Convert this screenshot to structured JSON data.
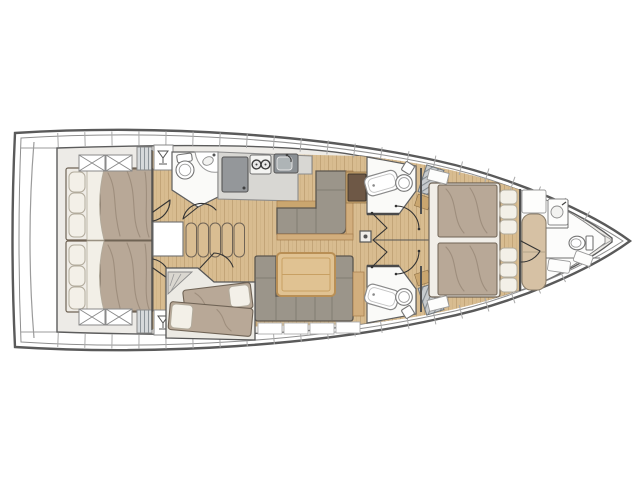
{
  "document": {
    "type": "sailing yacht interior layout floor plan",
    "view": "overhead deck plan",
    "bow_direction": "right",
    "background": "#ffffff"
  },
  "colors": {
    "hull_outline": "#5a5a5a",
    "deck_line": "#8f8f8f",
    "interior_fill": "#edebe7",
    "wood_floor": "#d8bc90",
    "wood_plank_line": "#c3a578",
    "wall": "#4f4f4f",
    "mattress": "#b8a897",
    "mattress_outline": "#6f6355",
    "pillow": "#f3f0e8",
    "pillow_stroke": "#b2ab9c",
    "settee_gray": "#9b958a",
    "settee_outline": "#5b564e",
    "wood_trim": "#d2ae7d",
    "table_wood": "#e0c292",
    "table_frame": "#b98f55",
    "counter_gray": "#d8d7d3",
    "appliance_gray": "#94979a",
    "sink_gray": "#8a8f93",
    "nav_table_brown": "#6e5846",
    "stairs_wood": "#d9bd92",
    "bow_berth_beige": "#d6c1a4",
    "fixture_white": "#fbfbfa",
    "fixture_stroke": "#757575",
    "hatch_stripe": "#8d9499",
    "door_line": "#333333"
  },
  "regions": [
    {
      "id": "swim-platform"
    },
    {
      "id": "aft-cabin-port",
      "fixtures": [
        "double-berth",
        "pillows",
        "hatch-cross-locker",
        "louvered-locker",
        "hanging-locker"
      ]
    },
    {
      "id": "aft-cabin-starboard",
      "fixtures": [
        "double-berth",
        "pillows",
        "hatch-cross-locker",
        "louvered-locker",
        "hanging-locker"
      ]
    },
    {
      "id": "companionway",
      "fixtures": [
        "stairs-5-steps"
      ]
    },
    {
      "id": "aft-head-port",
      "fixtures": [
        "toilet",
        "vanity-sink",
        "door"
      ]
    },
    {
      "id": "galley",
      "fixtures": [
        "refrigerator",
        "two-burner-stove",
        "sink"
      ]
    },
    {
      "id": "dinette",
      "fixtures": [
        "l-shaped-settee",
        "nav-table"
      ]
    },
    {
      "id": "salon",
      "fixtures": [
        "u-shaped-settee",
        "table",
        "mast-post"
      ]
    },
    {
      "id": "bunk-cabin-starboard",
      "fixtures": [
        "two-single-berths",
        "pillows",
        "steps"
      ]
    },
    {
      "id": "forward-head-port",
      "fixtures": [
        "shower-tray",
        "toilet",
        "bifold-door",
        "louvered-vent"
      ]
    },
    {
      "id": "forward-head-starboard",
      "fixtures": [
        "shower-tray",
        "toilet",
        "bifold-door",
        "louvered-vent"
      ]
    },
    {
      "id": "owner-cabin",
      "fixtures": [
        "island-double-berth",
        "pillows",
        "double-doors"
      ]
    },
    {
      "id": "bow-compartment",
      "fixtures": [
        "single-berth",
        "sink",
        "toilet",
        "shelves"
      ]
    }
  ],
  "icon_names": [
    "toilet-icon",
    "sink-icon",
    "stove-burners-icon",
    "faucet-icon",
    "hanger-icon",
    "hatch-cross-icon",
    "louver-icon",
    "mast-icon",
    "door-swing-icon",
    "stairs-icon",
    "shower-tray-icon"
  ]
}
